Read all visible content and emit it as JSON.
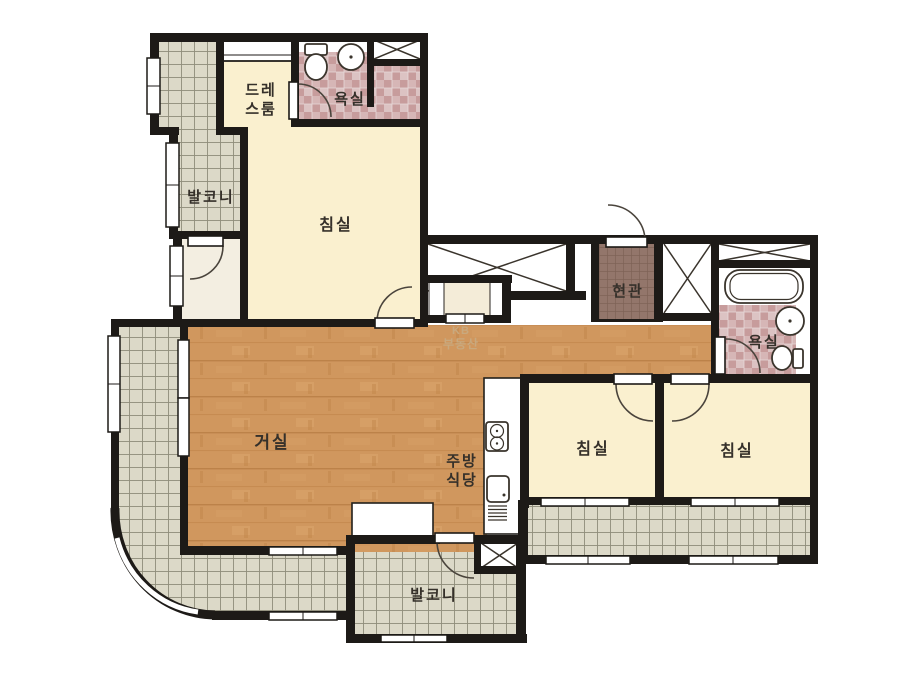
{
  "floor_plan": {
    "title": "apartment-floor-plan",
    "watermark": {
      "line1": "KB",
      "line2": "부동산"
    },
    "rooms": {
      "balcony_top_left": {
        "label": "발코니"
      },
      "dress_room": {
        "label_line1": "드레",
        "label_line2": "스룸"
      },
      "bathroom_top": {
        "label": "욕실"
      },
      "bedroom_top_left": {
        "label": "침실"
      },
      "entrance": {
        "label": "현관"
      },
      "bathroom_right": {
        "label": "욕실"
      },
      "living_room": {
        "label": "거실"
      },
      "kitchen_dining": {
        "label_line1": "주방",
        "label_line2": "식당"
      },
      "bedroom_bottom_left": {
        "label": "침실"
      },
      "bedroom_bottom_right": {
        "label": "침실"
      },
      "balcony_bottom": {
        "label": "발코니"
      }
    },
    "icons": {
      "toilet": "oval bowl with tank",
      "wash_basin": "round basin",
      "bathtub": "rounded rectangle tub",
      "stove": "two burner circles",
      "kitchen_sink": "rounded square basin",
      "duct_shaft": "box with X cross",
      "closet": "area with X cross"
    },
    "colors": {
      "wall": "#1d1a17",
      "room_cream": "#faf0cf",
      "pantry_cream": "#f4ecd8",
      "alcove_ivory": "#f3eee1",
      "tile_gray": "#dcd9c8",
      "bath_tile_pink": "#cda4a4",
      "entrance_tile_brown": "#93766b",
      "wood_floor": "#d0975e",
      "label_text": "#35302a",
      "watermark_tan": "#c9aa80"
    }
  }
}
